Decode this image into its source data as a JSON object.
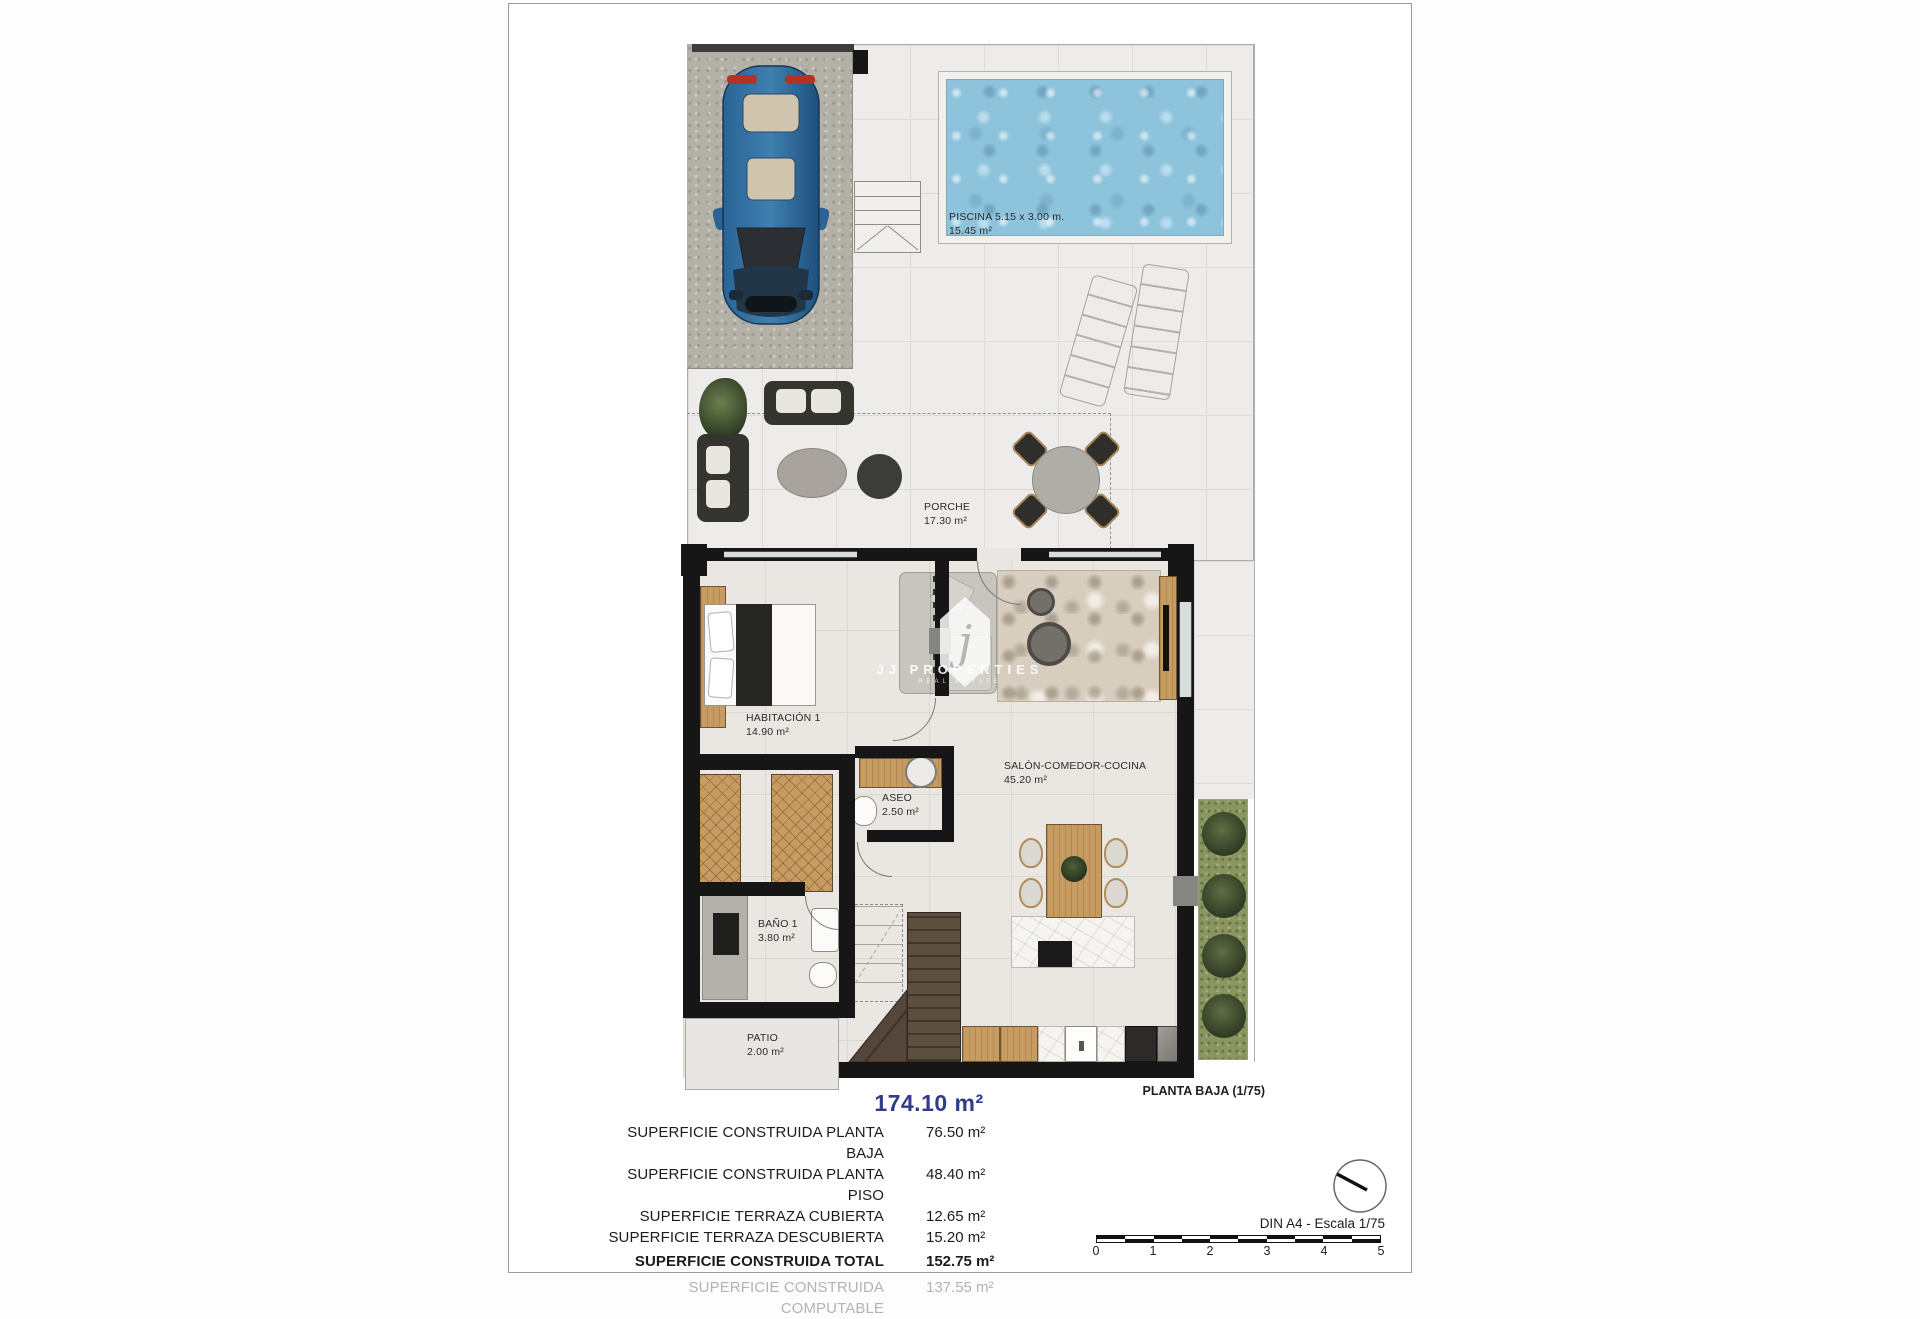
{
  "plan": {
    "title": "PLANTA BAJA (1/75)",
    "rooms": {
      "piscina": {
        "name": "PISCINA 5.15 x 3.00 m.",
        "area": "15.45 m²"
      },
      "porche": {
        "name": "PORCHE",
        "area": "17.30 m²"
      },
      "habitacion1": {
        "name": "HABITACIÓN 1",
        "area": "14.90 m²"
      },
      "aseo": {
        "name": "ASEO",
        "area": "2.50 m²"
      },
      "bano1": {
        "name": "BAÑO 1",
        "area": "3.80 m²"
      },
      "patio": {
        "name": "PATIO",
        "area": "2.00 m²"
      },
      "salon": {
        "name": "SALÓN-COMEDOR-COCINA",
        "area": "45.20 m²"
      }
    }
  },
  "summary": {
    "total": "174.10 m²",
    "rows": [
      {
        "label": "SUPERFICIE CONSTRUIDA PLANTA BAJA",
        "value": "76.50 m²"
      },
      {
        "label": "SUPERFICIE CONSTRUIDA PLANTA PISO",
        "value": "48.40 m²"
      },
      {
        "label": "SUPERFICIE TERRAZA CUBIERTA",
        "value": "12.65 m²"
      },
      {
        "label": "SUPERFICIE TERRAZA DESCUBIERTA",
        "value": "15.20 m²"
      },
      {
        "label": "SUPERFICIE CONSTRUIDA TOTAL",
        "value": "152.75 m²"
      },
      {
        "label": "SUPERFICIE CONSTRUIDA COMPUTABLE",
        "value": "137.55 m²"
      }
    ]
  },
  "scale": {
    "din_label": "DIN A4 - Escala 1/75",
    "ticks": [
      "0",
      "1",
      "2",
      "3",
      "4",
      "5"
    ]
  },
  "watermark": {
    "logo_letter": "j",
    "brand": "JJ PROPERTIES",
    "brand_sub": "REAL ESTATE"
  },
  "colors": {
    "accent_blue": "#323a8c",
    "pool_water": "#8ec3dc",
    "garden_green": "#8a9560",
    "wall_black": "#161616"
  }
}
